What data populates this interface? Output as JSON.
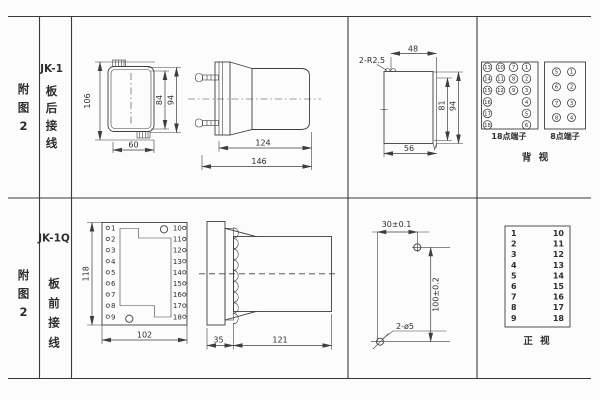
{
  "palette": {
    "bg": "#fcfcfc",
    "line": "#3e3e3e",
    "text": "#2e2e2e"
  },
  "row1": {
    "figure": [
      "附",
      "图",
      "2"
    ],
    "model": "JK-1",
    "wiring": [
      "板",
      "后",
      "接",
      "线"
    ],
    "front": {
      "h": "106",
      "w": "60",
      "hi": "84",
      "ho": "94"
    },
    "side": {
      "body": "124",
      "total": "146"
    },
    "cutout": {
      "r": "2-R2.5",
      "top": "48",
      "hi": "81",
      "ho": "94",
      "bottom": "56"
    },
    "rear": {
      "t18": {
        "caption": "18点端子",
        "col1": [
          "13",
          "14",
          "15",
          "16",
          "17",
          "18"
        ],
        "col2": [
          "10",
          "11",
          "12"
        ],
        "col3": [
          "7",
          "8",
          "9"
        ],
        "col4": [
          "1",
          "2",
          "3",
          "4",
          "5",
          "6"
        ]
      },
      "t8": {
        "caption": "8点端子",
        "col1": [
          "5",
          "6",
          "7",
          "8"
        ],
        "col2": [
          "1",
          "2",
          "3",
          "4"
        ]
      },
      "view": "背  视"
    }
  },
  "row2": {
    "figure": [
      "附",
      "图",
      "2"
    ],
    "model": "JK-1Q",
    "wiring": [
      "板",
      "前",
      "接",
      "线"
    ],
    "front": {
      "h": "118",
      "w": "102",
      "left": [
        "1",
        "2",
        "3",
        "4",
        "5",
        "6",
        "7",
        "8",
        "9"
      ],
      "right": [
        "10",
        "11",
        "12",
        "13",
        "14",
        "15",
        "16",
        "17",
        "18"
      ]
    },
    "side": {
      "plate": "35",
      "body": "121"
    },
    "drill": {
      "dx": "30±0.1",
      "dy": "100±0.2",
      "holes": "2-ø5"
    },
    "table": {
      "left": [
        "1",
        "2",
        "3",
        "4",
        "5",
        "6",
        "7",
        "8",
        "9"
      ],
      "right": [
        "10",
        "11",
        "12",
        "13",
        "14",
        "15",
        "16",
        "17",
        "18"
      ],
      "view": "正  视"
    }
  }
}
